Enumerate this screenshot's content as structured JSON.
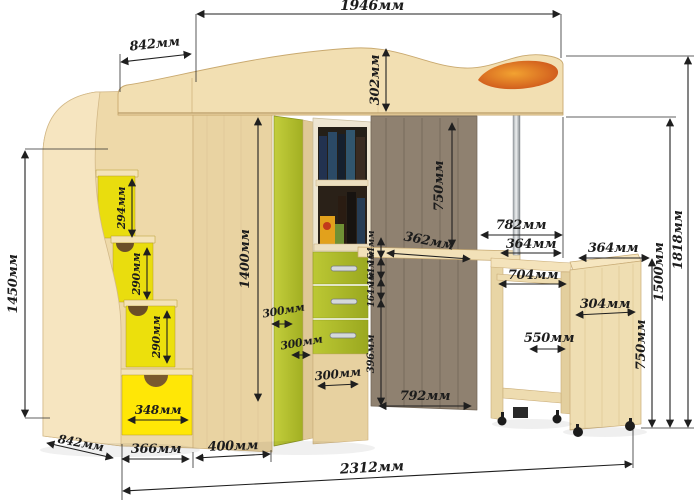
{
  "unit": "мм",
  "dims": {
    "d1946": "1946мм",
    "d842_top": "842мм",
    "d302": "302мм",
    "d750_desk": "750мм",
    "d782": "782мм",
    "d364_desk": "364мм",
    "d364_cabinet": "364мм",
    "d704": "704мм",
    "d304": "304мм",
    "d550": "550мм",
    "d750_cabinet": "750мм",
    "d1500": "1500мм",
    "d1818": "1818мм",
    "d362": "362мм",
    "d164_1": "164мм",
    "d164_2": "164мм",
    "d164_3": "164мм",
    "d396": "396мм",
    "d792": "792мм",
    "d1400": "1400мм",
    "d1450": "1450мм",
    "d294": "294мм",
    "d290_1": "290мм",
    "d290_2": "290мм",
    "d300_1": "300мм",
    "d300_2": "300мм",
    "d300_3": "300мм",
    "d348": "348мм",
    "d842_bottom": "842мм",
    "d366": "366мм",
    "d400": "400мм",
    "d2312": "2312мм"
  },
  "colors": {
    "background": "#ffffff",
    "wood_light": "#f3e1b6",
    "wood_mid": "#ecd7a6",
    "wood_shade": "#e2cb96",
    "green_front": "#b4c22d",
    "yellow_step": "#e9dd0e",
    "yellow_drawer": "#ffe706",
    "orange_decor": "#e07820",
    "dark_back_panel": "#8f8170",
    "chrome_pole": "#c8ccd0",
    "dimension_line": "#1f1f1f"
  }
}
